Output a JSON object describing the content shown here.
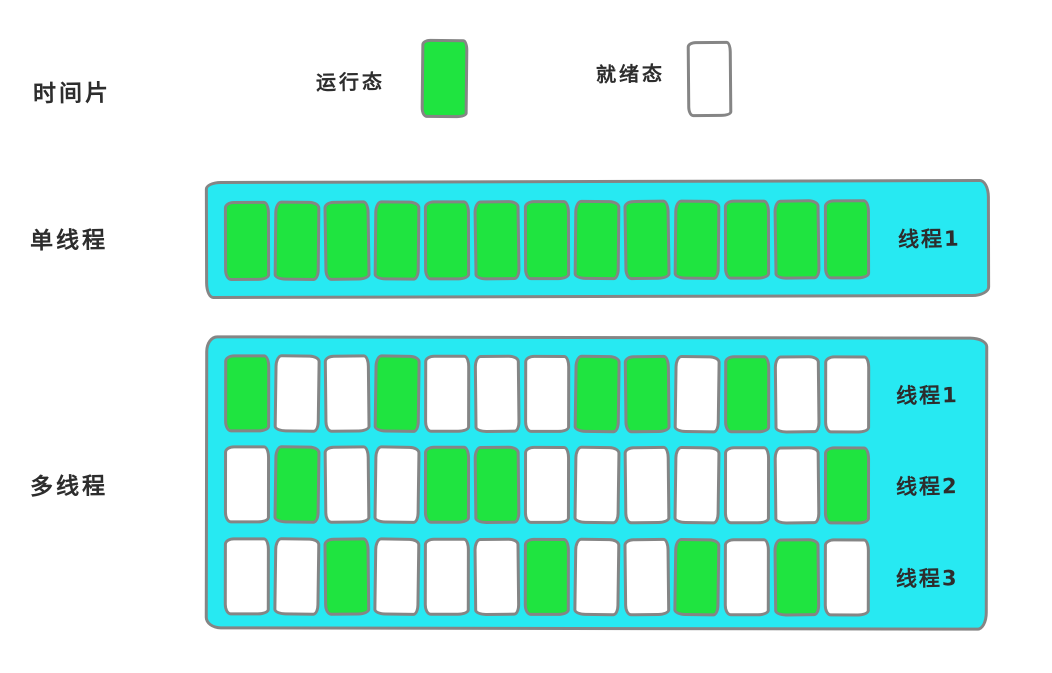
{
  "colors": {
    "running": "#1fe440",
    "ready": "#ffffff",
    "band": "#27e9f2",
    "stroke": "#858585",
    "text": "#2d2d2d"
  },
  "header": {
    "time_slice_label": "时间片",
    "legend": [
      {
        "label": "运行态",
        "state": "running"
      },
      {
        "label": "就绪态",
        "state": "ready"
      }
    ]
  },
  "sections": [
    {
      "label": "单线程",
      "rows": [
        {
          "thread_label": "线程1",
          "cells": [
            "R",
            "R",
            "R",
            "R",
            "R",
            "R",
            "R",
            "R",
            "R",
            "R",
            "R",
            "R",
            "R"
          ]
        }
      ]
    },
    {
      "label": "多线程",
      "rows": [
        {
          "thread_label": "线程1",
          "cells": [
            "R",
            "W",
            "W",
            "R",
            "W",
            "W",
            "W",
            "R",
            "R",
            "W",
            "R",
            "W",
            "W"
          ]
        },
        {
          "thread_label": "线程2",
          "cells": [
            "W",
            "R",
            "W",
            "W",
            "R",
            "R",
            "W",
            "W",
            "W",
            "W",
            "W",
            "W",
            "R"
          ]
        },
        {
          "thread_label": "线程3",
          "cells": [
            "W",
            "W",
            "R",
            "W",
            "W",
            "W",
            "R",
            "W",
            "W",
            "R",
            "W",
            "R",
            "W"
          ]
        }
      ]
    }
  ],
  "cell_states": {
    "R": "running",
    "W": "ready"
  }
}
